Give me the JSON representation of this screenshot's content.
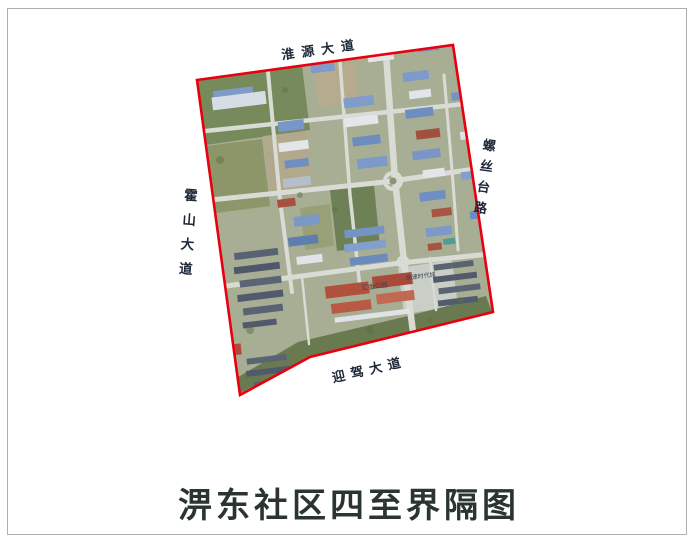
{
  "title": "淠东社区四至界隔图",
  "map": {
    "boundary_color": "#e8000f",
    "road_labels": {
      "top": "淮源大道",
      "bottom": "迎驾大道",
      "left": "霍山大道",
      "right": "螺丝台路"
    },
    "map_labels": [
      {
        "text": "汇金公园"
      },
      {
        "text": "高速时代城"
      }
    ]
  }
}
